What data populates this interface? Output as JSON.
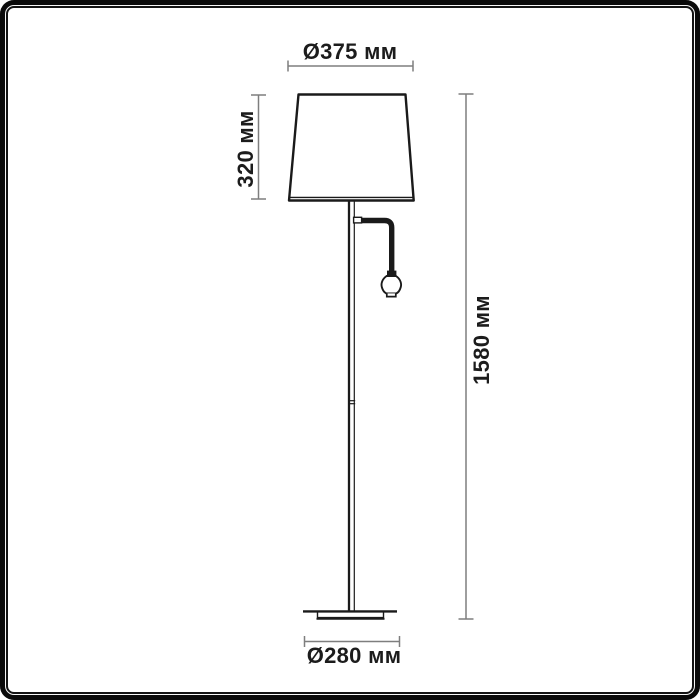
{
  "frame": {
    "border_color": "#0a0a0a",
    "background": "#ffffff"
  },
  "drawing": {
    "stroke_color": "#1a1a1a",
    "dimension_line_color": "#7e7e7e",
    "label_color": "#1c1c1c"
  },
  "labels": {
    "shade_diameter": "Ø375 мм",
    "shade_height": "320 мм",
    "total_height": "1580 мм",
    "base_diameter": "Ø280 мм"
  }
}
